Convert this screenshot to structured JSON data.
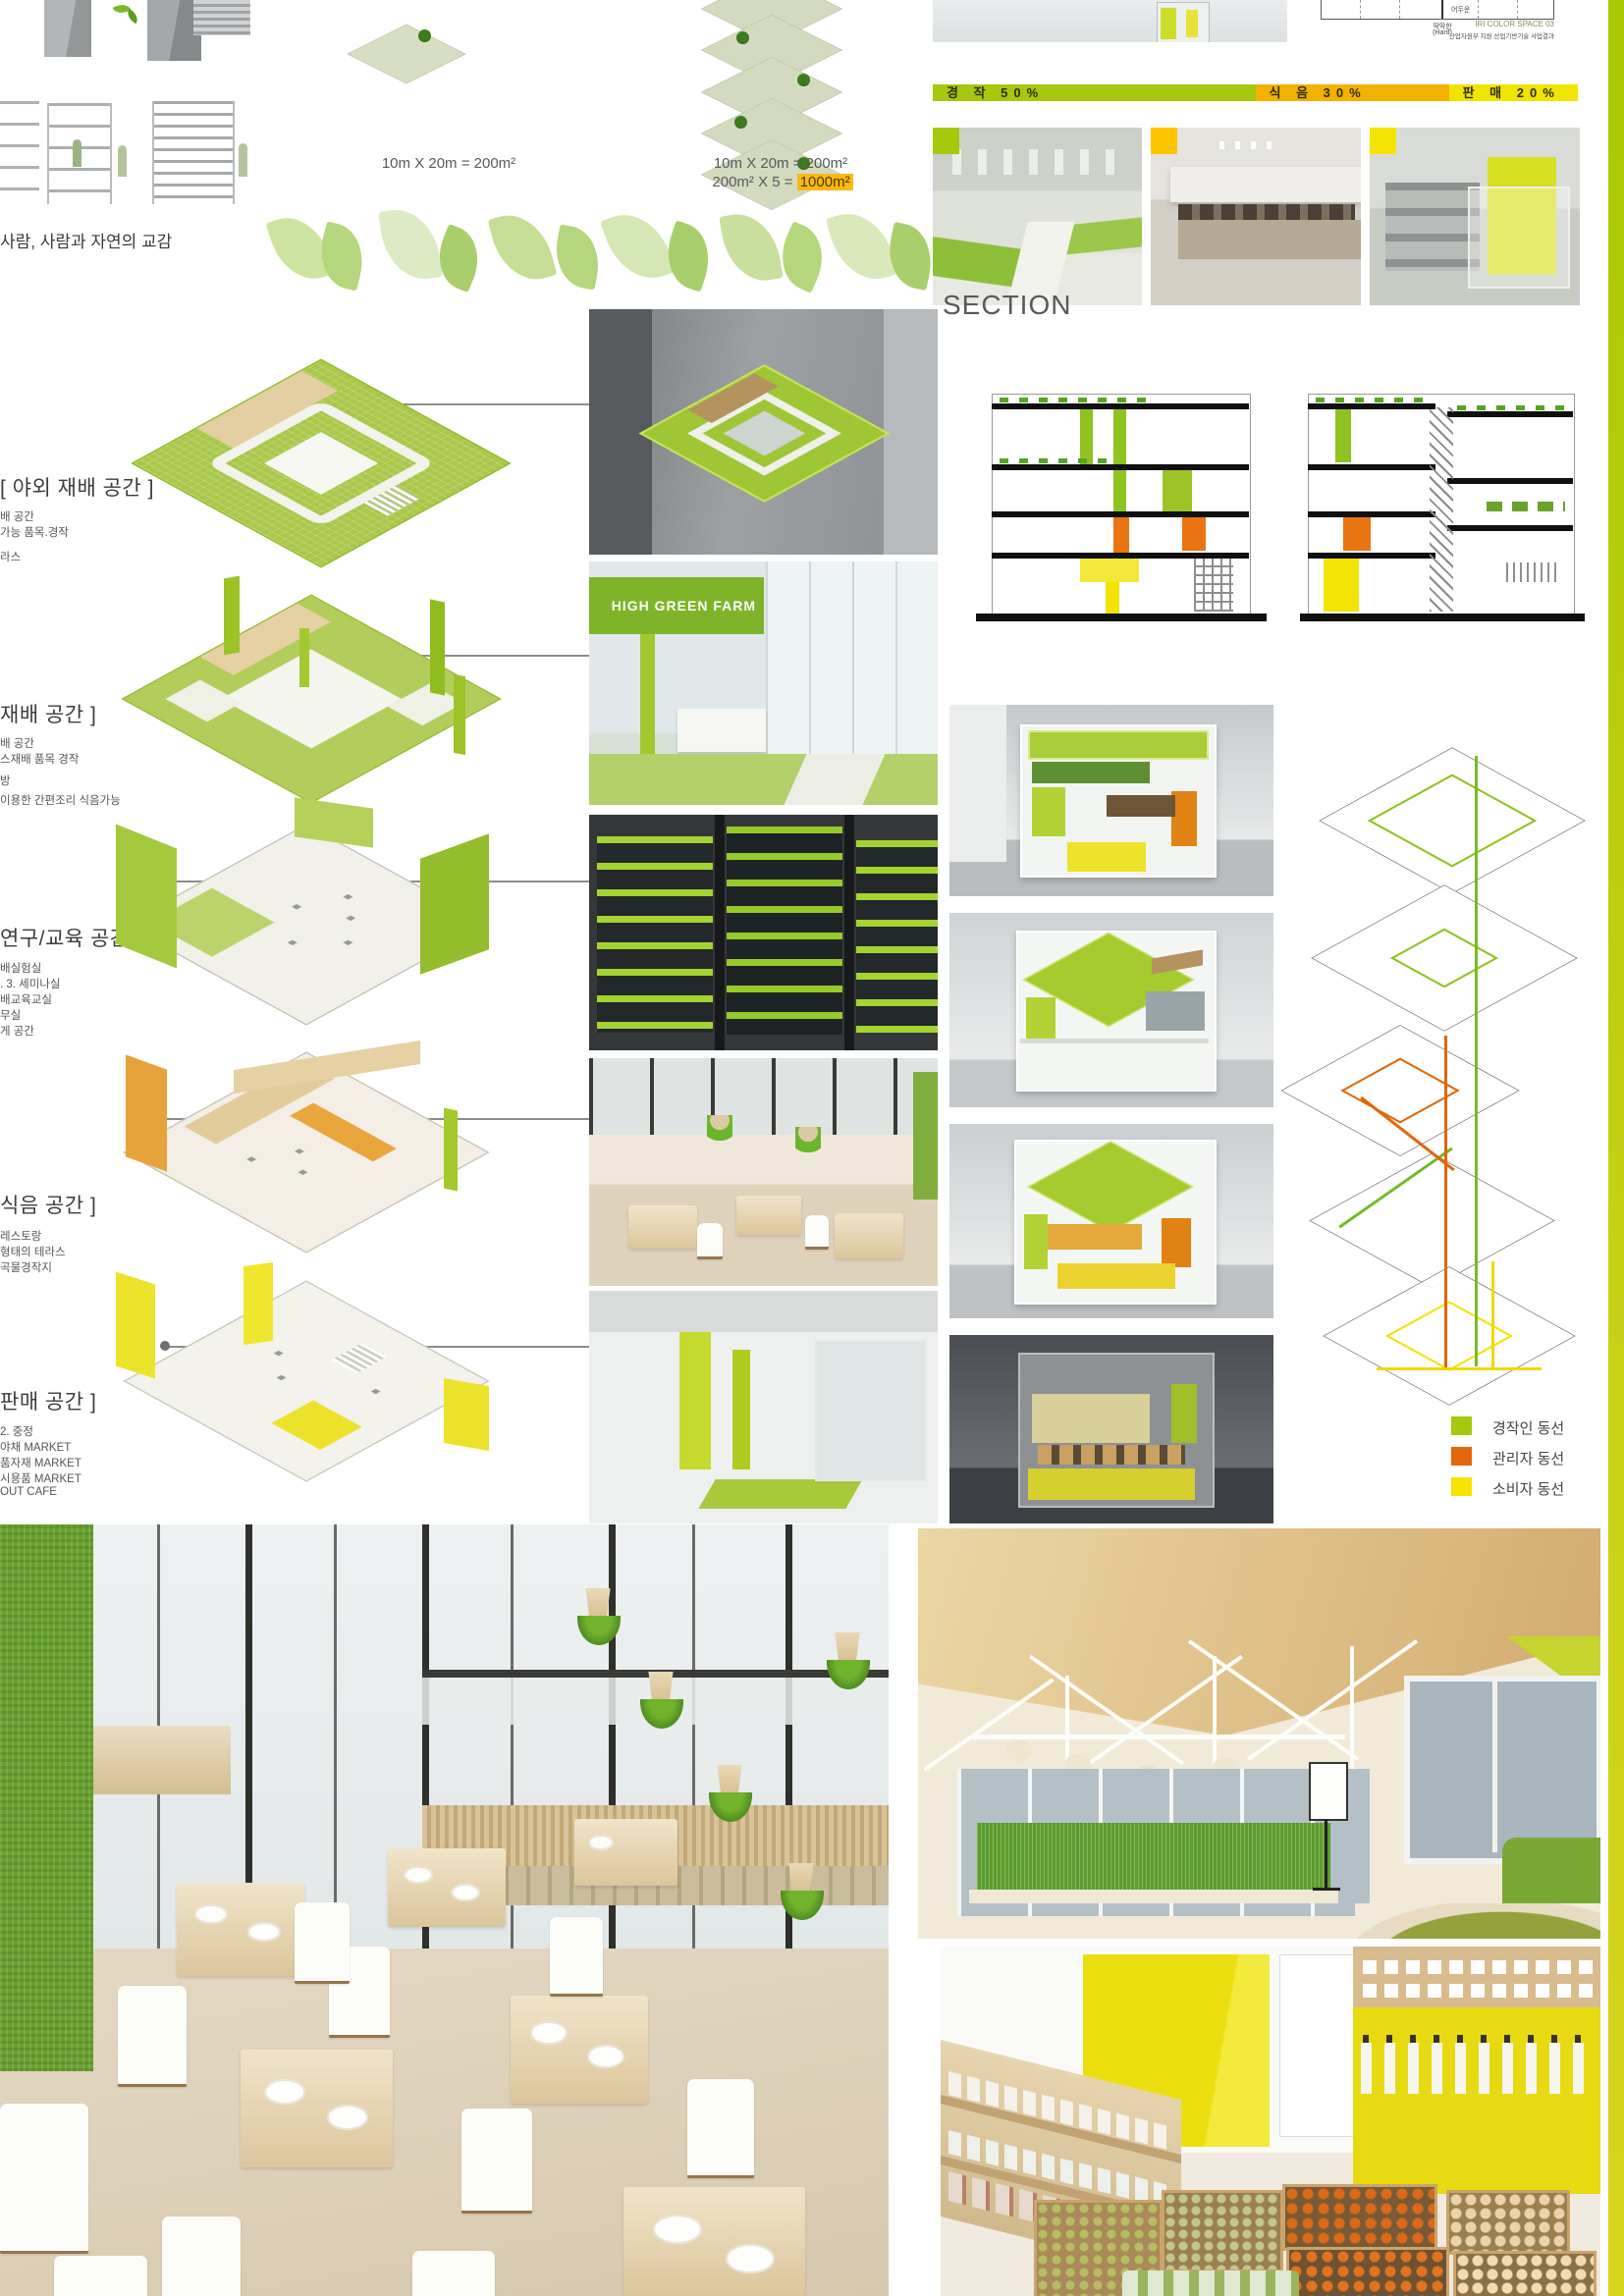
{
  "top": {
    "caption": "사람, 사람과 자연의 교감",
    "single_plot_label": "10m X 20m = 200m²",
    "stack_label_line1": "10m X 20m = 200m²",
    "stack_label_line2_prefix": "200m² X  5 =",
    "stack_label_highlight": "1000m²"
  },
  "iri_chart": {
    "inner_label": "어두운",
    "axis_label_line1": "딱딱한",
    "axis_label_line2": "(Hard)",
    "caption": "IRI COLOR SPACE 03",
    "credit": "산업자원부 지원 산업기반기술 사업결과"
  },
  "ratio_bar": {
    "segments": [
      {
        "label": "경 작 50%",
        "color": "#a6c80f",
        "percent": 50
      },
      {
        "label": "식 음 30%",
        "color": "#f3b100",
        "percent": 30
      },
      {
        "label": "판 매 20%",
        "color": "#f0e400",
        "percent": 20
      }
    ]
  },
  "floor_labels": [
    {
      "heading": "[ 야외 재배 공간 ]",
      "lines": [
        "배 공간",
        "가능 품목.경작",
        "라스"
      ]
    },
    {
      "heading": "재배 공간 ]",
      "lines": [
        "배 공간",
        "스재배 품목 경작",
        "방",
        "이용한 간편조리 식음가능"
      ]
    },
    {
      "heading": "연구/교육 공간 ]",
      "lines": [
        "배실험실",
        ". 3. 세미나실",
        "배교육교실",
        "무실",
        "게 공간"
      ]
    },
    {
      "heading": "식음 공간 ]",
      "lines": [
        "레스토랑",
        "형태의 테라스",
        "곡물경작지"
      ]
    },
    {
      "heading": "판매 공간 ]",
      "lines": [
        "2. 중정",
        "야채 MARKET",
        "품자재 MARKET",
        "시용품 MARKET",
        "OUT CAFE"
      ]
    }
  ],
  "section_title": "SECTION",
  "farm_sign": "HIGH GREEN FARM",
  "legend": {
    "items": [
      {
        "label": "경작인 동선",
        "color": "#a6c80f"
      },
      {
        "label": "관리자 동선",
        "color": "#e2660b"
      },
      {
        "label": "소비자 동선",
        "color": "#f5e400"
      }
    ]
  },
  "palette": {
    "lime": "#a6c80f",
    "orange": "#e2660b",
    "yellow": "#f5e400",
    "wood": "#e3cfa0",
    "highlight": "#fcb813",
    "plate_green": "#a9c748"
  }
}
